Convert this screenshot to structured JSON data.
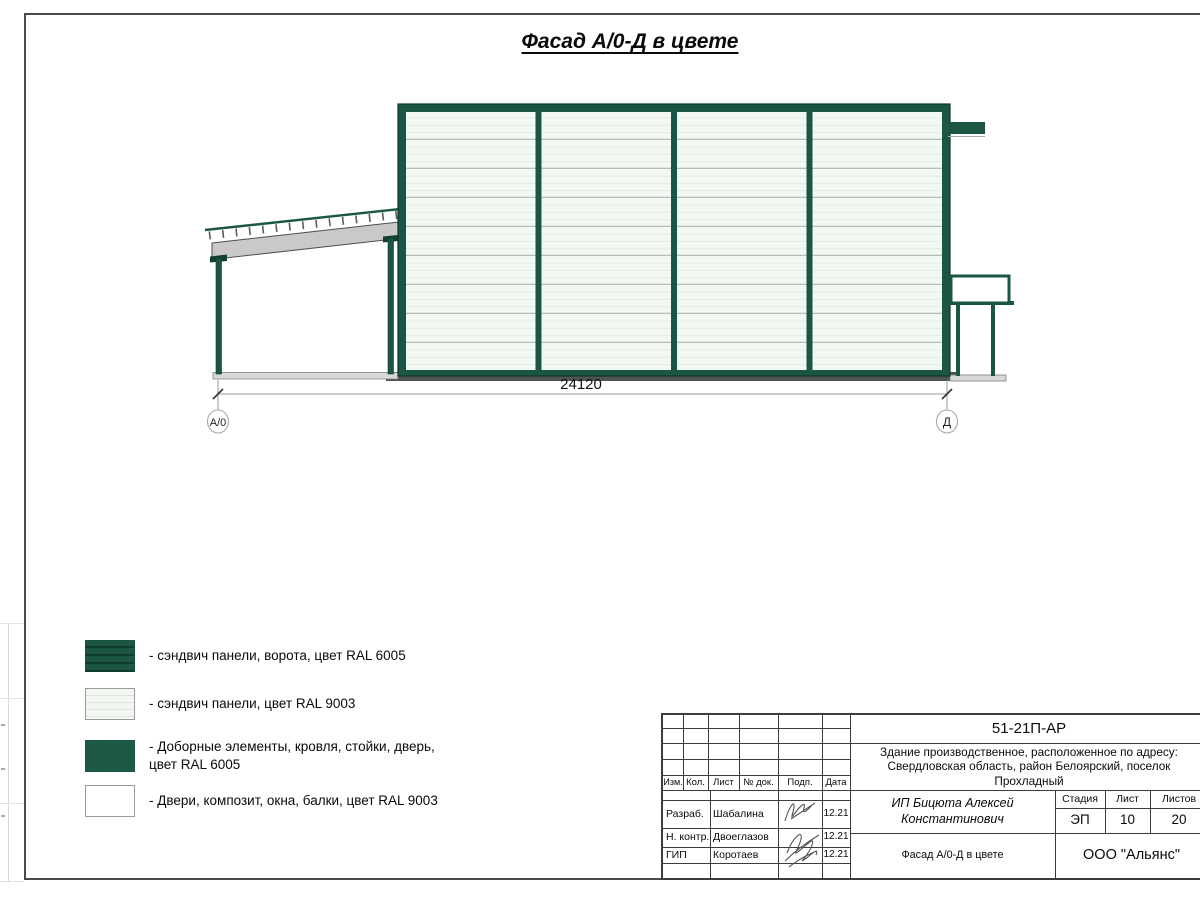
{
  "sheet": {
    "title": "Фасад А/0-Д в цвете"
  },
  "facade": {
    "dimension": "24120",
    "axis_left": "А/0",
    "axis_right": "Д",
    "frame_color": "#1b5645",
    "panel_color": "#f3f7f1"
  },
  "legend": {
    "items": [
      {
        "label": "- сэндвич панели, ворота, цвет RAL 6005",
        "color": "#1b5645",
        "style": "striped-dark"
      },
      {
        "label": "- сэндвич панели, цвет RAL 9003",
        "color": "#f3f7f1",
        "style": "striped-light"
      },
      {
        "label": "- Доборные элементы, кровля, стойки, дверь, цвет RAL 6005",
        "color": "#1d5846",
        "style": "solid"
      },
      {
        "label": "- Двери, композит, окна, балки, цвет RAL 9003",
        "color": "#ffffff",
        "style": "solid"
      }
    ]
  },
  "title_block": {
    "document_code": "51-21П-АР",
    "project_description": "Здание производственное, расположенное по адресу: Свердловская область, район Белоярский, поселок Прохладный",
    "revision_headers": {
      "izm": "Изм.",
      "kol": "Кол.",
      "list": "Лист",
      "doc": "№ док.",
      "podp": "Подп.",
      "data": "Дата"
    },
    "signers": [
      {
        "role": "Разраб.",
        "name": "Шабалина",
        "date": "12.21"
      },
      {
        "role": "Н. контр.",
        "name": "Двоеглазов",
        "date": "12.21"
      },
      {
        "role": "ГИП",
        "name": "Коротаев",
        "date": "12.21"
      }
    ],
    "client": "ИП Бицюта Алексей Константинович",
    "stage_label": "Стадия",
    "sheet_label": "Лист",
    "sheets_label": "Листов",
    "stage_value": "ЭП",
    "sheet_value": "10",
    "sheets_value": "20",
    "drawing_title": "Фасад А/0-Д в цвете",
    "organization": "ООО \"Альянс\""
  }
}
